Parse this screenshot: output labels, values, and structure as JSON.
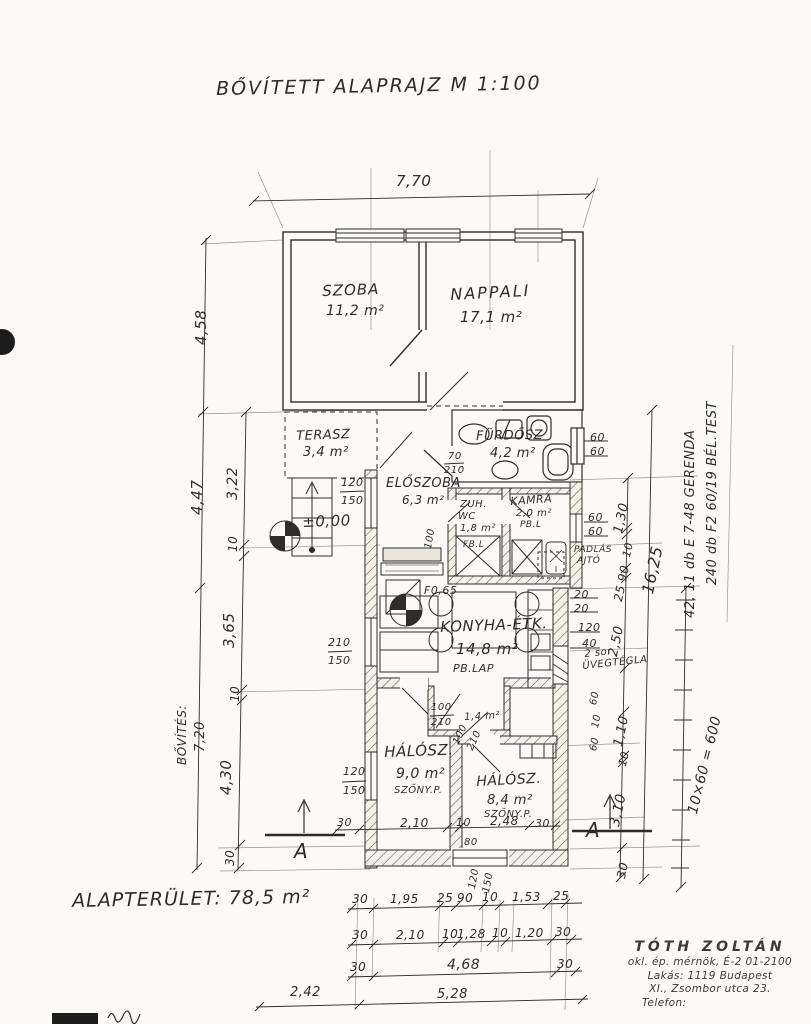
{
  "title": "BŐVÍTETT  ALAPRAJZ     M 1:100",
  "footer": {
    "area_label": "ALAPTERÜLET:  78,5 m²"
  },
  "rooms": {
    "szoba": {
      "name": "SZOBA",
      "area": "11,2 m²"
    },
    "nappali": {
      "name": "NAPPALI",
      "area": "17,1 m²"
    },
    "terasz": {
      "name": "TERASZ",
      "area": "3,4 m²"
    },
    "furdosz": {
      "name": "FÜRDŐSZ",
      "area": "4,2 m²"
    },
    "eloszoba": {
      "name": "ELŐSZOBA",
      "area": "6,3 m²"
    },
    "zuh": {
      "name": "ZUH.",
      "name2": "WC",
      "area": "1,8 m²",
      "finish": "FB.L"
    },
    "kamra": {
      "name": "KAMRA",
      "area": "2,0 m²",
      "finish": "PB.L"
    },
    "konyha": {
      "name": "KONYHA-ÉTK.",
      "area": "14,8 m²",
      "finish": "PB.LAP"
    },
    "gardrob": {
      "area": "1,4 m²"
    },
    "halosz1": {
      "name": "HÁLÓSZ.",
      "area": "9,0 m²",
      "finish": "SZŐNY.P."
    },
    "halosz2": {
      "name": "HÁLÓSZ.",
      "area": "8,4 m²",
      "finish": "SZŐNY.P."
    }
  },
  "levels": {
    "terrace": "±0,00",
    "kitchen": "F0,65"
  },
  "dims": {
    "top": "7,70",
    "left_outer": [
      "4,58",
      "4,47"
    ],
    "left_inner": [
      "3,22",
      "10",
      "3,65",
      "10",
      "4,30",
      "30"
    ],
    "bovites1": "BŐVÍTÉS:",
    "bovites2": "7,20",
    "right_total": "16,25",
    "right_chain": [
      "1,30",
      "10",
      "90",
      "25",
      "2,50",
      "1,10",
      "10",
      "3,10",
      "30"
    ],
    "right_col": [
      "60",
      "10",
      "60"
    ],
    "win_furdo": [
      "60",
      "60"
    ],
    "win_kamra": [
      "60",
      "60"
    ],
    "k2020": [
      "20",
      "20"
    ],
    "k12040": [
      "120",
      "40"
    ],
    "door_furdo": [
      "70",
      "210"
    ],
    "win_eloszoba": [
      "120",
      "150"
    ],
    "win_konyha": [
      "210",
      "150"
    ],
    "win_halosz": [
      "120",
      "150"
    ],
    "gardrob_door": [
      "100",
      "210"
    ],
    "gardrob_rot": [
      "100",
      "210"
    ],
    "eloszoba_door_rot": "100",
    "inner_row": [
      "30",
      "2,10",
      "10",
      "2,48",
      "30"
    ],
    "win_bottom": "80",
    "win_bottom_rot": [
      "120",
      "150"
    ],
    "rowA": [
      "30",
      "1,95",
      "25",
      "90",
      "10",
      "1,53",
      "25"
    ],
    "rowB": [
      "30",
      "2,10",
      "10",
      "1,28",
      "10",
      "1,20",
      "30"
    ],
    "rowC": [
      "30",
      "4,68",
      "30"
    ],
    "rowD": [
      "2,42",
      "5,28"
    ]
  },
  "notes": {
    "padlas1": "PADLÁS",
    "padlas2": "AJTÓ",
    "uveg1": "2 sor",
    "uveg2": "ÜVEGTÉGLA",
    "gerenda": "42,  11 db  E 7-48 GERENDA",
    "belestest": "240 db  F2 60/19 BÉL.TEST",
    "szorzat": "10×60 = 600"
  },
  "section": {
    "label": "A"
  },
  "stamp": {
    "name": "TÓTH  ZOLTÁN",
    "line2": "okl. ép. mérnök, É-2 01-2100",
    "line3": "Lakás: 1119  Budapest",
    "line4": "XI., Zsombor utca 23.",
    "line5": "Telefon:"
  }
}
